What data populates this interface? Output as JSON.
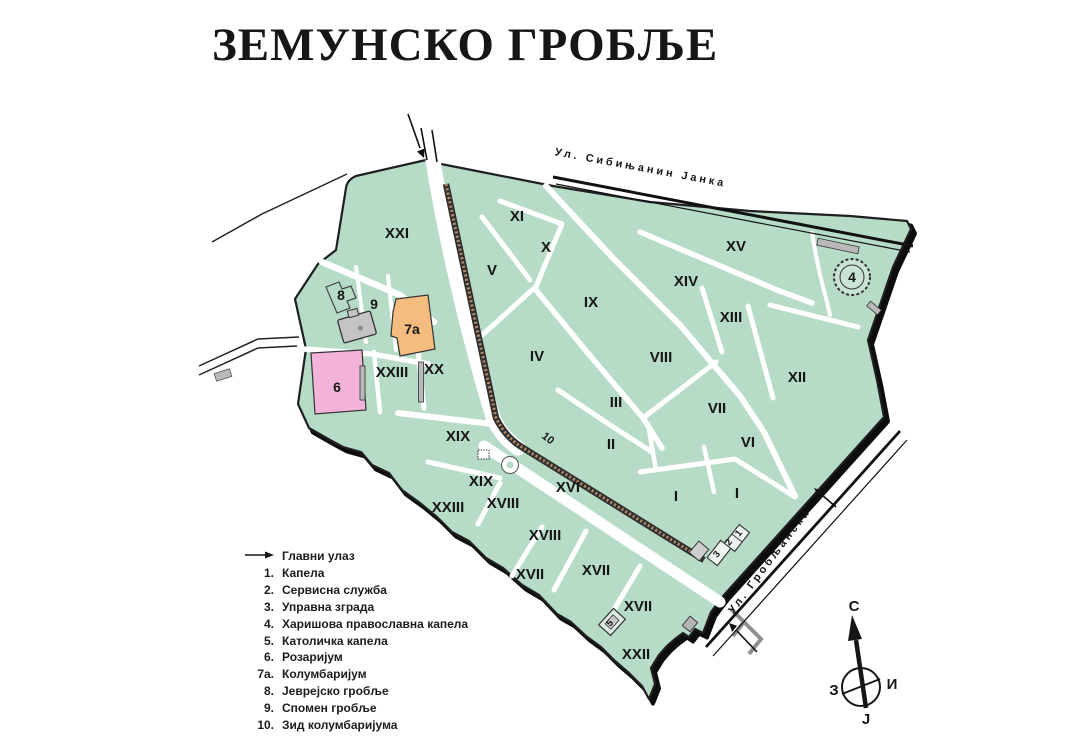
{
  "title": "ЗЕМУНСКО ГРОБЉЕ",
  "streets": {
    "top": "Ул. Сибињанин Јанка",
    "right": "Ул. Гробљанска"
  },
  "legend": {
    "entrance_label": "Главни улаз",
    "items": [
      {
        "num": "1.",
        "label": "Капела"
      },
      {
        "num": "2.",
        "label": "Сервисна служба"
      },
      {
        "num": "3.",
        "label": "Управна зграда"
      },
      {
        "num": "4.",
        "label": "Харишова православна капела"
      },
      {
        "num": "5.",
        "label": "Католичка капела"
      },
      {
        "num": "6.",
        "label": "Розаријум"
      },
      {
        "num": "7а.",
        "label": "Колумбаријум"
      },
      {
        "num": "8.",
        "label": "Јеврејско гробље"
      },
      {
        "num": "9.",
        "label": "Спомен гробље"
      },
      {
        "num": "10.",
        "label": "Зид колумбаријума"
      }
    ]
  },
  "compass": {
    "north": "С",
    "south": "Ј",
    "west": "З",
    "east": "И"
  },
  "map": {
    "sections": [
      {
        "label": "XXI"
      },
      {
        "label": "XI"
      },
      {
        "label": "X"
      },
      {
        "label": "V"
      },
      {
        "label": "IX"
      },
      {
        "label": "XV"
      },
      {
        "label": "XIV"
      },
      {
        "label": "XIII"
      },
      {
        "label": "VIII"
      },
      {
        "label": "IV"
      },
      {
        "label": "XII"
      },
      {
        "label": "III"
      },
      {
        "label": "VII"
      },
      {
        "label": "VI"
      },
      {
        "label": "II"
      },
      {
        "label": "XVI"
      },
      {
        "label": "I"
      },
      {
        "label": "I"
      },
      {
        "label": "XIX"
      },
      {
        "label": "XIX"
      },
      {
        "label": "XX"
      },
      {
        "label": "XXIII"
      },
      {
        "label": "XXIII"
      },
      {
        "label": "XVIII"
      },
      {
        "label": "XVIII"
      },
      {
        "label": "XVII"
      },
      {
        "label": "XVII"
      },
      {
        "label": "XVII"
      },
      {
        "label": "XXII"
      }
    ],
    "areas": [
      {
        "label": "8"
      },
      {
        "label": "9"
      },
      {
        "label": "7а"
      },
      {
        "label": "6"
      },
      {
        "label": "4"
      },
      {
        "label": "10"
      },
      {
        "label": "3"
      },
      {
        "label": "2"
      },
      {
        "label": "1"
      },
      {
        "label": "5"
      }
    ]
  },
  "colors": {
    "cemetery_green": "#b6dbc6",
    "columbarium_orange": "#f5bc80",
    "rosarium_pink": "#f3b3d9",
    "building_gray": "#c4c4c4",
    "outline": "#1f1f1f"
  }
}
